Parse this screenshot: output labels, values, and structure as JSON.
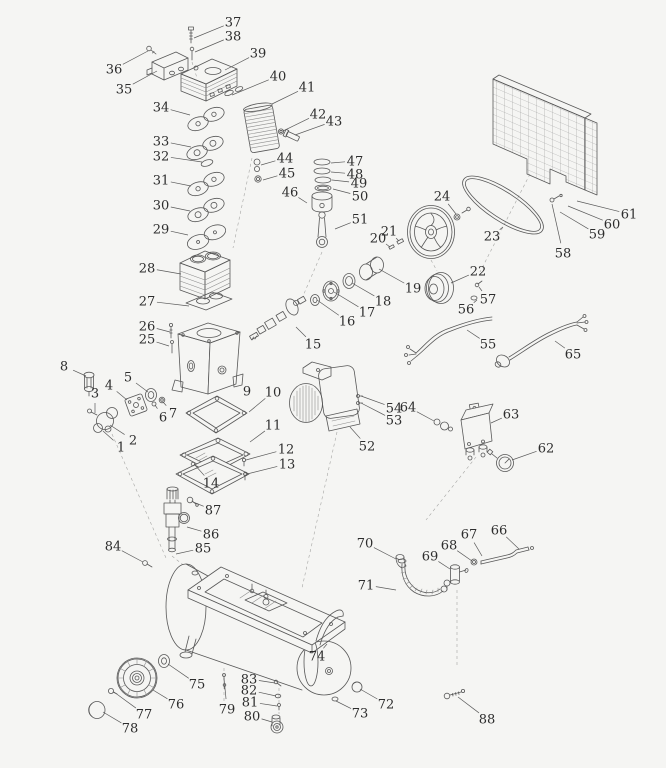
{
  "meta": {
    "kind": "exploded-parts-diagram",
    "subject": "belt-drive air compressor",
    "part_count": 88,
    "line_color": "#585858",
    "background": "#f5f5f3"
  },
  "labels": [
    {
      "n": "1",
      "x": 121,
      "y": 447,
      "tx": 103,
      "ty": 431
    },
    {
      "n": "2",
      "x": 133,
      "y": 440,
      "tx": 110,
      "ty": 425
    },
    {
      "n": "3",
      "x": 95,
      "y": 393,
      "tx": 95,
      "ty": 413
    },
    {
      "n": "4",
      "x": 109,
      "y": 385,
      "tx": 127,
      "ty": 400
    },
    {
      "n": "5",
      "x": 128,
      "y": 377,
      "tx": 148,
      "ty": 392
    },
    {
      "n": "6",
      "x": 163,
      "y": 417,
      "tx": 155,
      "ty": 405
    },
    {
      "n": "7",
      "x": 173,
      "y": 413,
      "tx": 163,
      "ty": 402
    },
    {
      "n": "8",
      "x": 64,
      "y": 366,
      "tx": 86,
      "ty": 376
    },
    {
      "n": "9",
      "x": 247,
      "y": 391,
      "tx": 242,
      "ty": 386
    },
    {
      "n": "10",
      "x": 273,
      "y": 392,
      "tx": 249,
      "ty": 412
    },
    {
      "n": "11",
      "x": 273,
      "y": 425,
      "tx": 250,
      "ty": 442
    },
    {
      "n": "12",
      "x": 286,
      "y": 449,
      "tx": 246,
      "ty": 460
    },
    {
      "n": "13",
      "x": 287,
      "y": 464,
      "tx": 247,
      "ty": 474
    },
    {
      "n": "14",
      "x": 211,
      "y": 483,
      "tx": 194,
      "ty": 464
    },
    {
      "n": "15",
      "x": 313,
      "y": 344,
      "tx": 296,
      "ty": 327
    },
    {
      "n": "16",
      "x": 347,
      "y": 321,
      "tx": 317,
      "ty": 300
    },
    {
      "n": "17",
      "x": 367,
      "y": 312,
      "tx": 334,
      "ty": 292
    },
    {
      "n": "18",
      "x": 383,
      "y": 301,
      "tx": 352,
      "ty": 283
    },
    {
      "n": "19",
      "x": 413,
      "y": 288,
      "tx": 379,
      "ty": 269
    },
    {
      "n": "20",
      "x": 378,
      "y": 238,
      "tx": 390,
      "ty": 247
    },
    {
      "n": "21",
      "x": 389,
      "y": 231,
      "tx": 399,
      "ty": 241
    },
    {
      "n": "22",
      "x": 478,
      "y": 271,
      "tx": 451,
      "ty": 283
    },
    {
      "n": "23",
      "x": 492,
      "y": 236,
      "tx": 503,
      "ty": 227
    },
    {
      "n": "24",
      "x": 442,
      "y": 196,
      "tx": 456,
      "ty": 214
    },
    {
      "n": "25",
      "x": 147,
      "y": 339,
      "tx": 169,
      "ty": 346
    },
    {
      "n": "26",
      "x": 147,
      "y": 326,
      "tx": 170,
      "ty": 332
    },
    {
      "n": "27",
      "x": 147,
      "y": 301,
      "tx": 189,
      "ty": 306
    },
    {
      "n": "28",
      "x": 147,
      "y": 268,
      "tx": 181,
      "ty": 274
    },
    {
      "n": "29",
      "x": 161,
      "y": 229,
      "tx": 188,
      "ty": 235
    },
    {
      "n": "30",
      "x": 161,
      "y": 205,
      "tx": 190,
      "ty": 211
    },
    {
      "n": "31",
      "x": 161,
      "y": 180,
      "tx": 191,
      "ty": 186
    },
    {
      "n": "32",
      "x": 161,
      "y": 156,
      "tx": 202,
      "ty": 162
    },
    {
      "n": "33",
      "x": 161,
      "y": 141,
      "tx": 191,
      "ty": 147
    },
    {
      "n": "34",
      "x": 161,
      "y": 107,
      "tx": 190,
      "ty": 115
    },
    {
      "n": "35",
      "x": 124,
      "y": 89,
      "tx": 157,
      "ty": 71
    },
    {
      "n": "36",
      "x": 114,
      "y": 69,
      "tx": 148,
      "ty": 51
    },
    {
      "n": "37",
      "x": 233,
      "y": 22,
      "tx": 194,
      "ty": 38
    },
    {
      "n": "38",
      "x": 233,
      "y": 36,
      "tx": 195,
      "ty": 52
    },
    {
      "n": "39",
      "x": 258,
      "y": 53,
      "tx": 225,
      "ty": 70
    },
    {
      "n": "40",
      "x": 278,
      "y": 76,
      "tx": 232,
      "ty": 95
    },
    {
      "n": "41",
      "x": 307,
      "y": 87,
      "tx": 272,
      "ty": 104
    },
    {
      "n": "42",
      "x": 318,
      "y": 114,
      "tx": 283,
      "ty": 131
    },
    {
      "n": "43",
      "x": 334,
      "y": 121,
      "tx": 295,
      "ty": 135
    },
    {
      "n": "44",
      "x": 285,
      "y": 158,
      "tx": 261,
      "ty": 165
    },
    {
      "n": "45",
      "x": 287,
      "y": 173,
      "tx": 263,
      "ty": 180
    },
    {
      "n": "46",
      "x": 290,
      "y": 192,
      "tx": 307,
      "ty": 203
    },
    {
      "n": "47",
      "x": 355,
      "y": 161,
      "tx": 331,
      "ty": 163
    },
    {
      "n": "48",
      "x": 355,
      "y": 174,
      "tx": 331,
      "ty": 172
    },
    {
      "n": "49",
      "x": 359,
      "y": 183,
      "tx": 332,
      "ty": 180
    },
    {
      "n": "50",
      "x": 360,
      "y": 196,
      "tx": 333,
      "ty": 189
    },
    {
      "n": "51",
      "x": 360,
      "y": 219,
      "tx": 335,
      "ty": 229
    },
    {
      "n": "52",
      "x": 367,
      "y": 446,
      "tx": 350,
      "ty": 427
    },
    {
      "n": "53",
      "x": 394,
      "y": 420,
      "tx": 361,
      "ty": 403
    },
    {
      "n": "54",
      "x": 394,
      "y": 408,
      "tx": 361,
      "ty": 396
    },
    {
      "n": "55",
      "x": 488,
      "y": 344,
      "tx": 467,
      "ty": 330
    },
    {
      "n": "56",
      "x": 466,
      "y": 309,
      "tx": 477,
      "ty": 300
    },
    {
      "n": "57",
      "x": 488,
      "y": 299,
      "tx": 479,
      "ty": 287
    },
    {
      "n": "58",
      "x": 563,
      "y": 253,
      "tx": 552,
      "ty": 204
    },
    {
      "n": "59",
      "x": 597,
      "y": 234,
      "tx": 560,
      "ty": 212
    },
    {
      "n": "60",
      "x": 612,
      "y": 224,
      "tx": 568,
      "ty": 206
    },
    {
      "n": "61",
      "x": 629,
      "y": 214,
      "tx": 577,
      "ty": 201
    },
    {
      "n": "62",
      "x": 546,
      "y": 448,
      "tx": 512,
      "ty": 460
    },
    {
      "n": "63",
      "x": 511,
      "y": 414,
      "tx": 491,
      "ty": 423
    },
    {
      "n": "64",
      "x": 408,
      "y": 407,
      "tx": 434,
      "ty": 421
    },
    {
      "n": "65",
      "x": 573,
      "y": 354,
      "tx": 555,
      "ty": 341
    },
    {
      "n": "66",
      "x": 499,
      "y": 530,
      "tx": 519,
      "ty": 549
    },
    {
      "n": "67",
      "x": 469,
      "y": 534,
      "tx": 482,
      "ty": 556
    },
    {
      "n": "68",
      "x": 449,
      "y": 545,
      "tx": 472,
      "ty": 561
    },
    {
      "n": "69",
      "x": 430,
      "y": 556,
      "tx": 450,
      "ty": 569
    },
    {
      "n": "70",
      "x": 365,
      "y": 543,
      "tx": 396,
      "ty": 559
    },
    {
      "n": "71",
      "x": 366,
      "y": 585,
      "tx": 396,
      "ty": 590
    },
    {
      "n": "72",
      "x": 386,
      "y": 704,
      "tx": 360,
      "ty": 689
    },
    {
      "n": "73",
      "x": 360,
      "y": 713,
      "tx": 336,
      "ty": 701
    },
    {
      "n": "74",
      "x": 317,
      "y": 656,
      "tx": 327,
      "ty": 644
    },
    {
      "n": "75",
      "x": 197,
      "y": 684,
      "tx": 168,
      "ty": 664
    },
    {
      "n": "76",
      "x": 176,
      "y": 704,
      "tx": 153,
      "ty": 690
    },
    {
      "n": "77",
      "x": 144,
      "y": 714,
      "tx": 114,
      "ty": 692
    },
    {
      "n": "78",
      "x": 130,
      "y": 728,
      "tx": 103,
      "ty": 712
    },
    {
      "n": "79",
      "x": 227,
      "y": 709,
      "tx": 224,
      "ty": 678
    },
    {
      "n": "80",
      "x": 252,
      "y": 716,
      "tx": 272,
      "ty": 722
    },
    {
      "n": "81",
      "x": 250,
      "y": 702,
      "tx": 277,
      "ty": 706
    },
    {
      "n": "82",
      "x": 249,
      "y": 690,
      "tx": 276,
      "ty": 696
    },
    {
      "n": "83",
      "x": 249,
      "y": 679,
      "tx": 275,
      "ty": 683
    },
    {
      "n": "84",
      "x": 113,
      "y": 546,
      "tx": 143,
      "ty": 562
    },
    {
      "n": "85",
      "x": 203,
      "y": 548,
      "tx": 176,
      "ty": 554
    },
    {
      "n": "86",
      "x": 211,
      "y": 534,
      "tx": 187,
      "ty": 527
    },
    {
      "n": "87",
      "x": 213,
      "y": 510,
      "tx": 193,
      "ty": 502
    },
    {
      "n": "88",
      "x": 487,
      "y": 719,
      "tx": 458,
      "ty": 697
    }
  ]
}
